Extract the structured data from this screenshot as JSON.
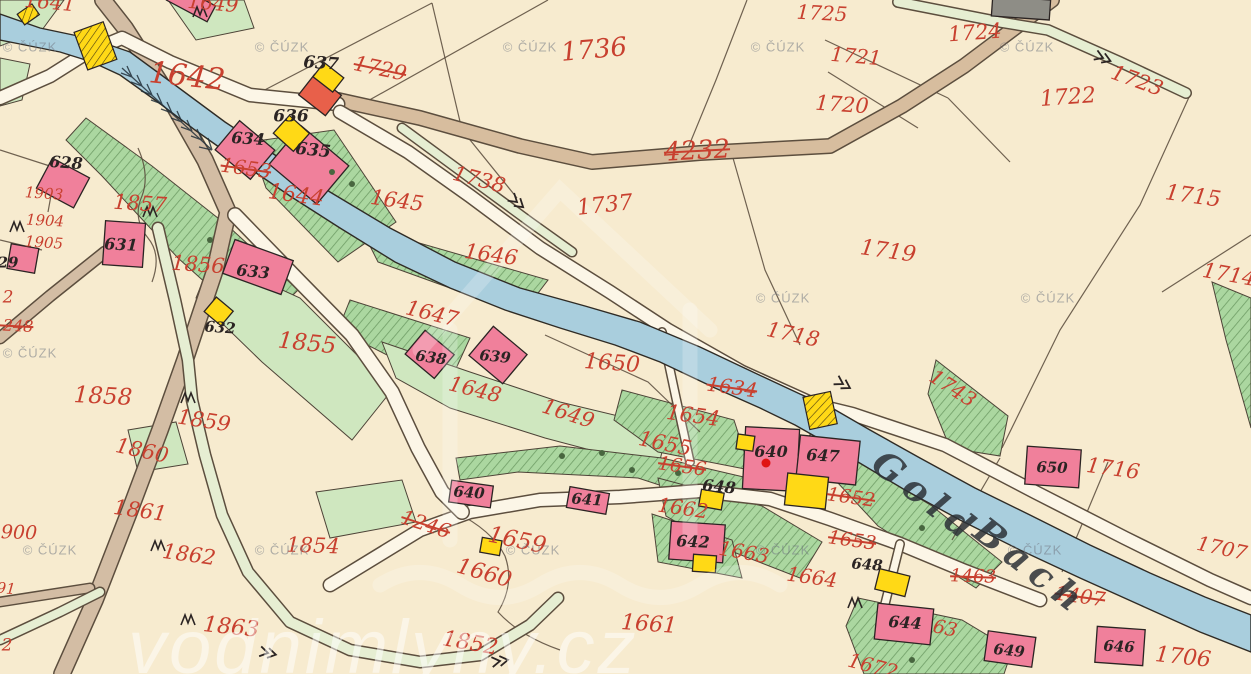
{
  "map": {
    "title": "Historical cadastral map sheet",
    "colors": {
      "paper": "#f7ebcf",
      "stream": "#a9cedd",
      "road_brown": "#d7bd9e",
      "road_tan": "#d3bda4",
      "road_white": "#fcf6e7",
      "path_green": "#e6eed2",
      "meadow_light": "#cfe7bf",
      "masonry": "#f0809b",
      "masonry_red": "#e8604a",
      "wood": "#ffd916",
      "ink_red": "#c8402f",
      "ink_black": "#2b2423"
    }
  },
  "stream": {
    "name": "Gold Bach",
    "name_parts": [
      {
        "t": "Gold",
        "x": 926,
        "y": 497,
        "s": 36,
        "r": 38
      },
      {
        "t": "Bach",
        "x": 1031,
        "y": 567,
        "s": 36,
        "r": 38
      }
    ]
  },
  "watermarks": {
    "cuzk_text": "© ČÚZK",
    "site_text": "vodnimlyny.cz",
    "cuzk_positions": [
      [
        30,
        47
      ],
      [
        282,
        47
      ],
      [
        530,
        47
      ],
      [
        778,
        47
      ],
      [
        1027,
        47
      ],
      [
        783,
        298
      ],
      [
        1048,
        298
      ],
      [
        30,
        353
      ],
      [
        50,
        550
      ],
      [
        282,
        550
      ],
      [
        533,
        550
      ],
      [
        783,
        550
      ],
      [
        1035,
        550
      ]
    ]
  },
  "labels": {
    "parcels": [
      {
        "t": "1642",
        "x": 187,
        "y": 77,
        "s": 30,
        "r": 6
      },
      {
        "t": "1641",
        "x": 50,
        "y": 2,
        "s": 20,
        "r": 5
      },
      {
        "t": "1649",
        "x": 213,
        "y": 3,
        "s": 20,
        "r": 5
      },
      {
        "t": "1729",
        "x": 380,
        "y": 69,
        "s": 21,
        "r": 12,
        "k": true
      },
      {
        "t": "1736",
        "x": 594,
        "y": 50,
        "s": 26,
        "r": -5
      },
      {
        "t": "1725",
        "x": 822,
        "y": 13,
        "s": 20,
        "r": 3
      },
      {
        "t": "1721",
        "x": 856,
        "y": 56,
        "s": 20,
        "r": 5
      },
      {
        "t": "1724",
        "x": 975,
        "y": 33,
        "s": 21,
        "r": -4
      },
      {
        "t": "1720",
        "x": 842,
        "y": 105,
        "s": 21,
        "r": 4
      },
      {
        "t": "1722",
        "x": 1068,
        "y": 98,
        "s": 22,
        "r": -4
      },
      {
        "t": "1723",
        "x": 1137,
        "y": 81,
        "s": 21,
        "r": 20
      },
      {
        "t": "1715",
        "x": 1193,
        "y": 197,
        "s": 22,
        "r": 8
      },
      {
        "t": "1714",
        "x": 1229,
        "y": 275,
        "s": 21,
        "r": 10
      },
      {
        "t": "4232",
        "x": 697,
        "y": 151,
        "s": 26,
        "r": -3,
        "k": true
      },
      {
        "t": "1738",
        "x": 479,
        "y": 180,
        "s": 21,
        "r": 15
      },
      {
        "t": "1737",
        "x": 605,
        "y": 206,
        "s": 22,
        "r": -6
      },
      {
        "t": "1719",
        "x": 888,
        "y": 252,
        "s": 22,
        "r": 8
      },
      {
        "t": "1644",
        "x": 296,
        "y": 196,
        "s": 22,
        "r": 8
      },
      {
        "t": "1645",
        "x": 397,
        "y": 201,
        "s": 21,
        "r": 8
      },
      {
        "t": "1646",
        "x": 491,
        "y": 255,
        "s": 21,
        "r": 8
      },
      {
        "t": "1653",
        "x": 246,
        "y": 168,
        "s": 20,
        "r": 8,
        "k": true
      },
      {
        "t": "1857",
        "x": 140,
        "y": 204,
        "s": 21,
        "r": 4
      },
      {
        "t": "1903",
        "x": 44,
        "y": 194,
        "s": 15,
        "r": 4
      },
      {
        "t": "1904",
        "x": 45,
        "y": 221,
        "s": 15,
        "r": 3
      },
      {
        "t": "1905",
        "x": 44,
        "y": 243,
        "s": 15,
        "r": 4
      },
      {
        "t": "2",
        "x": 8,
        "y": 298,
        "s": 17,
        "r": 0
      },
      {
        "t": "1248",
        "x": 13,
        "y": 326,
        "s": 16,
        "r": 3,
        "k": true
      },
      {
        "t": "1856",
        "x": 198,
        "y": 265,
        "s": 21,
        "r": 4
      },
      {
        "t": "1855",
        "x": 307,
        "y": 344,
        "s": 23,
        "r": 6
      },
      {
        "t": "1647",
        "x": 432,
        "y": 314,
        "s": 21,
        "r": 14
      },
      {
        "t": "1650",
        "x": 612,
        "y": 364,
        "s": 22,
        "r": 4
      },
      {
        "t": "1718",
        "x": 793,
        "y": 335,
        "s": 21,
        "r": 12
      },
      {
        "t": "1743",
        "x": 953,
        "y": 388,
        "s": 20,
        "r": 33
      },
      {
        "t": "1858",
        "x": 103,
        "y": 397,
        "s": 23,
        "r": 3
      },
      {
        "t": "1859",
        "x": 204,
        "y": 421,
        "s": 21,
        "r": 9
      },
      {
        "t": "1860",
        "x": 142,
        "y": 451,
        "s": 21,
        "r": 12
      },
      {
        "t": "1861",
        "x": 140,
        "y": 511,
        "s": 21,
        "r": 8
      },
      {
        "t": "1900",
        "x": 13,
        "y": 533,
        "s": 19,
        "r": 2
      },
      {
        "t": "1862",
        "x": 189,
        "y": 555,
        "s": 21,
        "r": 8
      },
      {
        "t": "1854",
        "x": 313,
        "y": 546,
        "s": 21,
        "r": 2
      },
      {
        "t": "91",
        "x": 6,
        "y": 589,
        "s": 15,
        "r": 5
      },
      {
        "t": "2",
        "x": 7,
        "y": 646,
        "s": 17,
        "r": 0
      },
      {
        "t": "1863",
        "x": 231,
        "y": 628,
        "s": 22,
        "r": 6
      },
      {
        "t": "1852",
        "x": 470,
        "y": 644,
        "s": 22,
        "r": 10
      },
      {
        "t": "1246",
        "x": 426,
        "y": 524,
        "s": 20,
        "r": 18,
        "k": true
      },
      {
        "t": "1659",
        "x": 517,
        "y": 541,
        "s": 23,
        "r": 12
      },
      {
        "t": "1660",
        "x": 484,
        "y": 574,
        "s": 22,
        "r": 16
      },
      {
        "t": "1661",
        "x": 649,
        "y": 625,
        "s": 22,
        "r": 4
      },
      {
        "t": "1648",
        "x": 475,
        "y": 390,
        "s": 21,
        "r": 14
      },
      {
        "t": "1649",
        "x": 568,
        "y": 414,
        "s": 21,
        "r": 18
      },
      {
        "t": "1654",
        "x": 693,
        "y": 416,
        "s": 21,
        "r": 8
      },
      {
        "t": "1634",
        "x": 732,
        "y": 387,
        "s": 20,
        "r": 8,
        "k": true
      },
      {
        "t": "1655",
        "x": 665,
        "y": 444,
        "s": 21,
        "r": 12
      },
      {
        "t": "1656",
        "x": 682,
        "y": 467,
        "s": 19,
        "r": 8,
        "k": true
      },
      {
        "t": "1662",
        "x": 683,
        "y": 508,
        "s": 20,
        "r": 8
      },
      {
        "t": "1663",
        "x": 744,
        "y": 552,
        "s": 20,
        "r": 10
      },
      {
        "t": "1664",
        "x": 812,
        "y": 577,
        "s": 20,
        "r": 8
      },
      {
        "t": "1652",
        "x": 851,
        "y": 498,
        "s": 19,
        "r": 8,
        "k": true
      },
      {
        "t": "1653",
        "x": 852,
        "y": 541,
        "s": 19,
        "r": 8,
        "k": true
      },
      {
        "t": "1463",
        "x": 973,
        "y": 577,
        "s": 18,
        "r": 2,
        "k": true
      },
      {
        "t": "1407",
        "x": 1080,
        "y": 596,
        "s": 20,
        "r": 8,
        "k": true
      },
      {
        "t": "1716",
        "x": 1113,
        "y": 469,
        "s": 21,
        "r": 8
      },
      {
        "t": "1707",
        "x": 1222,
        "y": 548,
        "s": 20,
        "r": 12
      },
      {
        "t": "1706",
        "x": 1183,
        "y": 658,
        "s": 22,
        "r": 6
      },
      {
        "t": "1672",
        "x": 873,
        "y": 666,
        "s": 20,
        "r": 15
      },
      {
        "t": "63",
        "x": 945,
        "y": 629,
        "s": 19,
        "r": 12
      }
    ],
    "buildings": [
      {
        "t": "637",
        "x": 321,
        "y": 64,
        "s": 17,
        "r": 4
      },
      {
        "t": "636",
        "x": 291,
        "y": 117,
        "s": 17,
        "r": 0
      },
      {
        "t": "634",
        "x": 248,
        "y": 139,
        "s": 16,
        "r": 4
      },
      {
        "t": "635",
        "x": 313,
        "y": 151,
        "s": 17,
        "r": 6
      },
      {
        "t": "628",
        "x": 66,
        "y": 163,
        "s": 16,
        "r": 4
      },
      {
        "t": "29",
        "x": 8,
        "y": 263,
        "s": 15,
        "r": 0
      },
      {
        "t": "631",
        "x": 121,
        "y": 245,
        "s": 16,
        "r": 3
      },
      {
        "t": "633",
        "x": 253,
        "y": 272,
        "s": 16,
        "r": 6
      },
      {
        "t": "632",
        "x": 220,
        "y": 328,
        "s": 15,
        "r": 4
      },
      {
        "t": "638",
        "x": 431,
        "y": 358,
        "s": 15,
        "r": 8
      },
      {
        "t": "639",
        "x": 495,
        "y": 357,
        "s": 15,
        "r": 6
      },
      {
        "t": "640",
        "x": 469,
        "y": 493,
        "s": 15,
        "r": 4
      },
      {
        "t": "641",
        "x": 587,
        "y": 500,
        "s": 15,
        "r": 4
      },
      {
        "t": "648",
        "x": 719,
        "y": 487,
        "s": 16,
        "r": 6
      },
      {
        "t": "642",
        "x": 693,
        "y": 542,
        "s": 16,
        "r": 3
      },
      {
        "t": "640",
        "x": 771,
        "y": 452,
        "s": 16,
        "r": 0
      },
      {
        "t": "647",
        "x": 823,
        "y": 456,
        "s": 16,
        "r": 3
      },
      {
        "t": "648",
        "x": 867,
        "y": 565,
        "s": 15,
        "r": 4
      },
      {
        "t": "644",
        "x": 905,
        "y": 623,
        "s": 16,
        "r": 4
      },
      {
        "t": "649",
        "x": 1009,
        "y": 651,
        "s": 15,
        "r": 6
      },
      {
        "t": "646",
        "x": 1119,
        "y": 647,
        "s": 15,
        "r": 3
      },
      {
        "t": "650",
        "x": 1052,
        "y": 468,
        "s": 15,
        "r": 2
      }
    ]
  }
}
